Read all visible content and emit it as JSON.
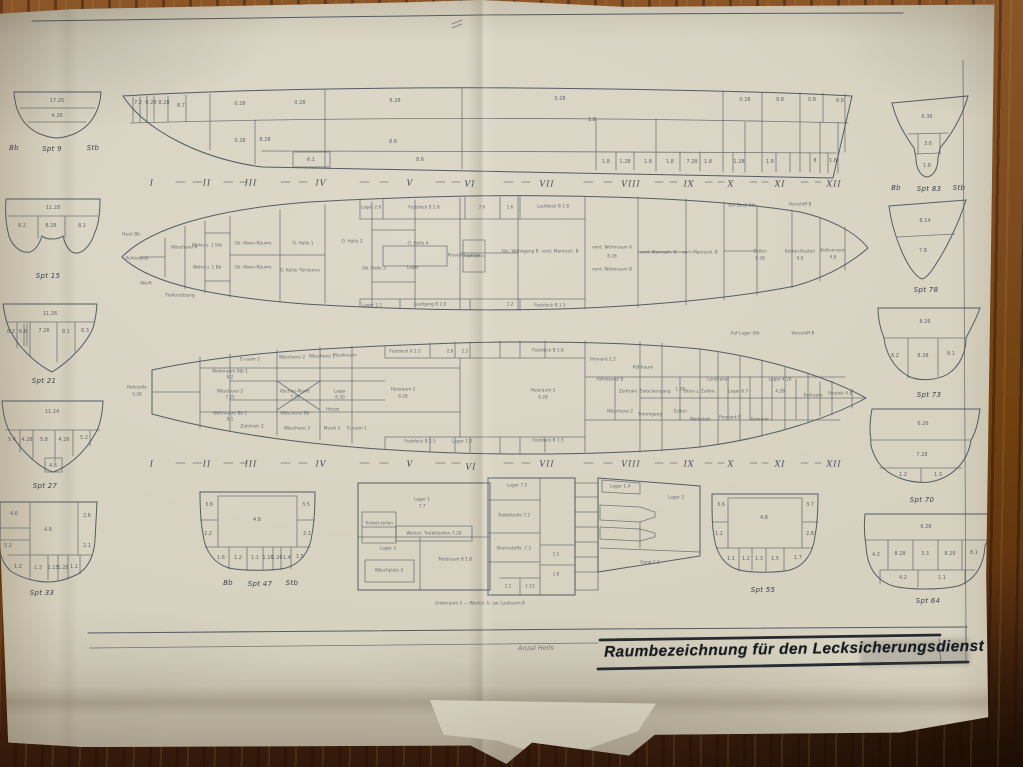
{
  "colors": {
    "paper": "#d7d1bf",
    "ink": "#46535f",
    "wood": "#7c4a1e",
    "title_ink": "#151a21"
  },
  "title_block": {
    "title": "Raumbezeichnung für den Lecksicherungsdienst",
    "annotation": "Anzal Heils"
  },
  "labels": [
    {
      "group": "frame-numerals-top",
      "cls": "rom",
      "items": [
        [
          152,
          183,
          "I"
        ],
        [
          207,
          183,
          "II"
        ],
        [
          251,
          183,
          "III"
        ],
        [
          321,
          183,
          "IV"
        ],
        [
          410,
          183,
          "V"
        ],
        [
          470,
          184,
          "VI"
        ],
        [
          547,
          184,
          "VII"
        ],
        [
          631,
          184,
          "VIII"
        ],
        [
          689,
          184,
          "IX"
        ],
        [
          731,
          184,
          "X"
        ],
        [
          780,
          184,
          "XI"
        ],
        [
          834,
          184,
          "XII"
        ]
      ]
    },
    {
      "group": "frame-numerals-bottom",
      "cls": "rom",
      "items": [
        [
          152,
          464,
          "I"
        ],
        [
          207,
          464,
          "II"
        ],
        [
          251,
          464,
          "III"
        ],
        [
          321,
          464,
          "IV"
        ],
        [
          410,
          464,
          "V"
        ],
        [
          471,
          467,
          "VI"
        ],
        [
          547,
          464,
          "VII"
        ],
        [
          631,
          464,
          "VIII"
        ],
        [
          689,
          464,
          "IX"
        ],
        [
          731,
          464,
          "X"
        ],
        [
          780,
          464,
          "XI"
        ],
        [
          834,
          464,
          "XII"
        ]
      ]
    },
    {
      "group": "section-titles",
      "cls": "spt",
      "items": [
        [
          14,
          148,
          "Bb",
          "section-label-bb-aft"
        ],
        [
          52,
          149,
          "Spt 9",
          "section-label-spt-9"
        ],
        [
          93,
          148,
          "Stb",
          "section-label-stb-aft"
        ],
        [
          48,
          276,
          "Spt 15",
          "section-label-spt-15"
        ],
        [
          44,
          381,
          "Spt 21",
          "section-label-spt-21"
        ],
        [
          45,
          486,
          "Spt 27",
          "section-label-spt-27"
        ],
        [
          42,
          593,
          "Spt 33",
          "section-label-spt-33"
        ],
        [
          896,
          188,
          "Bb",
          "section-label-bb-fwd"
        ],
        [
          929,
          189,
          "Spt 83",
          "section-label-spt-83"
        ],
        [
          959,
          188,
          "Stb",
          "section-label-stb-fwd"
        ],
        [
          926,
          290,
          "Spt 78",
          "section-label-spt-78"
        ],
        [
          929,
          395,
          "Spt 73",
          "section-label-spt-73"
        ],
        [
          922,
          500,
          "Spt 70",
          "section-label-spt-70"
        ],
        [
          928,
          601,
          "Spt 64",
          "section-label-spt-64"
        ],
        [
          228,
          583,
          "Bb",
          "section-label-bb-mid"
        ],
        [
          260,
          584,
          "Spt 47",
          "section-label-spt-47"
        ],
        [
          292,
          583,
          "Stb",
          "section-label-stb-mid"
        ],
        [
          763,
          590,
          "Spt 55",
          "section-label-spt-55"
        ]
      ]
    },
    {
      "group": "section-cells",
      "cls": "num",
      "items": [
        [
          57,
          101,
          "17.25"
        ],
        [
          57,
          116,
          "4.26"
        ],
        [
          53,
          208,
          "11.28"
        ],
        [
          22,
          226,
          "8.2"
        ],
        [
          51,
          226,
          "8.28"
        ],
        [
          82,
          226,
          "8.1"
        ],
        [
          50,
          314,
          "11.26"
        ],
        [
          11,
          332,
          "8.2"
        ],
        [
          23,
          332,
          "6.6"
        ],
        [
          44,
          331,
          "7.26"
        ],
        [
          66,
          332,
          "8.1"
        ],
        [
          85,
          331,
          "8.3"
        ],
        [
          52,
          412,
          "11.24"
        ],
        [
          12,
          440,
          "5.4"
        ],
        [
          27,
          440,
          "4.28"
        ],
        [
          44,
          440,
          "5.8"
        ],
        [
          64,
          440,
          "4.26"
        ],
        [
          84,
          438,
          "5.2"
        ],
        [
          53,
          466,
          "4.6"
        ],
        [
          14,
          514,
          "4.6"
        ],
        [
          48,
          530,
          "4.8"
        ],
        [
          87,
          516,
          "2.6"
        ],
        [
          8,
          546,
          "5.2"
        ],
        [
          87,
          546,
          "2.1"
        ],
        [
          18,
          567,
          "1.2"
        ],
        [
          38,
          568,
          "1.3"
        ],
        [
          53,
          568,
          "1.15"
        ],
        [
          63,
          568,
          "1.28"
        ],
        [
          74,
          567,
          "1.1"
        ],
        [
          927,
          117,
          "6.36"
        ],
        [
          928,
          144,
          "3.6"
        ],
        [
          927,
          166,
          "1.8"
        ],
        [
          925,
          221,
          "8.14"
        ],
        [
          923,
          251,
          "7.8"
        ],
        [
          925,
          322,
          "8.26"
        ],
        [
          895,
          356,
          "8.2"
        ],
        [
          923,
          356,
          "8.28"
        ],
        [
          951,
          354,
          "8.1"
        ],
        [
          923,
          424,
          "6.26"
        ],
        [
          922,
          455,
          "7.28"
        ],
        [
          903,
          475,
          "1.2"
        ],
        [
          938,
          475,
          "1.3"
        ],
        [
          926,
          527,
          "6.28"
        ],
        [
          876,
          555,
          "4.2"
        ],
        [
          900,
          554,
          "8.28"
        ],
        [
          925,
          554,
          "3.3"
        ],
        [
          950,
          554,
          "8.26"
        ],
        [
          974,
          553,
          "8.1"
        ],
        [
          903,
          578,
          "4.2"
        ],
        [
          942,
          578,
          "1.1"
        ],
        [
          209,
          505,
          "3.6"
        ],
        [
          257,
          520,
          "4.8"
        ],
        [
          306,
          505,
          "3.5"
        ],
        [
          208,
          534,
          "2.2"
        ],
        [
          307,
          534,
          "2.1"
        ],
        [
          221,
          558,
          "1.6"
        ],
        [
          238,
          558,
          "1.2"
        ],
        [
          255,
          558,
          "1.1"
        ],
        [
          268,
          558,
          "1.16"
        ],
        [
          277,
          558,
          "1.26"
        ],
        [
          287,
          558,
          "1.4"
        ],
        [
          300,
          557,
          "1.5"
        ],
        [
          721,
          505,
          "3.6"
        ],
        [
          764,
          518,
          "4.8"
        ],
        [
          810,
          505,
          "3.7"
        ],
        [
          719,
          534,
          "1.2"
        ],
        [
          810,
          534,
          "2.8"
        ],
        [
          731,
          559,
          "1.1"
        ],
        [
          746,
          559,
          "1.2"
        ],
        [
          759,
          559,
          "1.3"
        ],
        [
          775,
          559,
          "1.5"
        ],
        [
          798,
          558,
          "1.7"
        ]
      ]
    },
    {
      "group": "profile-cells",
      "cls": "num",
      "items": [
        [
          138,
          103,
          "7.2"
        ],
        [
          151,
          103,
          "0.28"
        ],
        [
          164,
          103,
          "8.28"
        ],
        [
          181,
          106,
          "8.7"
        ],
        [
          240,
          104,
          "0.28"
        ],
        [
          300,
          103,
          "0.28"
        ],
        [
          395,
          101,
          "8.28"
        ],
        [
          560,
          99,
          "0.28"
        ],
        [
          592,
          120,
          "1.8"
        ],
        [
          745,
          100,
          "0.28"
        ],
        [
          780,
          100,
          "9.8"
        ],
        [
          812,
          100,
          "0.8"
        ],
        [
          840,
          101,
          "8.8"
        ],
        [
          265,
          140,
          "8.28"
        ],
        [
          393,
          142,
          "8.8"
        ],
        [
          240,
          141,
          "0.28"
        ],
        [
          311,
          160,
          "6.1"
        ],
        [
          420,
          160,
          "8.6"
        ],
        [
          606,
          162,
          "1.8"
        ],
        [
          625,
          162,
          "1.28"
        ],
        [
          648,
          162,
          "1.8"
        ],
        [
          670,
          162,
          "1.8"
        ],
        [
          692,
          162,
          "7.28"
        ],
        [
          708,
          162,
          "1.8"
        ],
        [
          739,
          162,
          "1.28"
        ],
        [
          770,
          162,
          "1.8"
        ],
        [
          815,
          161,
          "8"
        ],
        [
          833,
          161,
          "1.8"
        ]
      ]
    },
    {
      "group": "upper-deck-rooms",
      "cls": "mic",
      "items": [
        [
          131,
          235,
          "Heck Bb"
        ],
        [
          137,
          259,
          "Achterpiek"
        ],
        [
          146,
          284,
          "Werft"
        ],
        [
          180,
          296,
          "Tiefersetzung"
        ],
        [
          184,
          248,
          "Wäscherei 4"
        ],
        [
          207,
          246,
          "Wohn u. 1 Stb"
        ],
        [
          207,
          268,
          "Wohn u. 1 Bb"
        ],
        [
          253,
          244,
          "Ob. Mann-Räume"
        ],
        [
          253,
          268,
          "Ob. Mann-Räume"
        ],
        [
          303,
          244,
          "O. Halle 1"
        ],
        [
          352,
          242,
          "O. Halle 2"
        ],
        [
          300,
          271,
          "O. Keller Türräume"
        ],
        [
          374,
          269,
          "Ob. Halle 3"
        ],
        [
          418,
          244,
          "O. Halle 4"
        ],
        [
          413,
          268,
          "Lager"
        ],
        [
          464,
          256,
          "Proviant-gänge"
        ],
        [
          520,
          252,
          "Hin. Wohngang B"
        ],
        [
          560,
          252,
          "vord. Mannsch. B"
        ],
        [
          612,
          248,
          "vord. Wohnraum A"
        ],
        [
          612,
          257,
          "8.28"
        ],
        [
          612,
          270,
          "vord. Wohnraum B"
        ],
        [
          658,
          253,
          "vord. Mannsch. B"
        ],
        [
          700,
          253,
          "vorn Mannsch. B"
        ],
        [
          760,
          252,
          "Zellen"
        ],
        [
          760,
          259,
          "6.28"
        ],
        [
          800,
          252,
          "Ketten-Kasten"
        ],
        [
          800,
          259,
          "6.8"
        ],
        [
          833,
          251,
          "Kettenraum"
        ],
        [
          833,
          258,
          "4.8"
        ],
        [
          371,
          208,
          "Lager 2.6"
        ],
        [
          424,
          208,
          "Festdeck B 2.6"
        ],
        [
          482,
          208,
          "7.6"
        ],
        [
          510,
          208,
          "1.6"
        ],
        [
          553,
          207,
          "Laufdeck B 1.8"
        ],
        [
          372,
          306,
          "Lager 2.1"
        ],
        [
          430,
          305,
          "Laufgang B 2.8"
        ],
        [
          510,
          305,
          "1.2"
        ],
        [
          550,
          306,
          "Festdeck B 1.5"
        ],
        [
          742,
          206,
          "Auf Deck Stb"
        ],
        [
          800,
          205,
          "Vorschiff B"
        ]
      ]
    },
    {
      "group": "lower-deck-rooms",
      "cls": "mic",
      "items": [
        [
          137,
          388,
          "Rohrzelle"
        ],
        [
          137,
          395,
          "5.28"
        ],
        [
          230,
          372,
          "Wohnraum Stb 1"
        ],
        [
          230,
          378,
          "9.2"
        ],
        [
          250,
          360,
          "E-raum 2"
        ],
        [
          292,
          358,
          "Wäscherei 2"
        ],
        [
          322,
          357,
          "Wäscherei 1"
        ],
        [
          345,
          356,
          "Musikraum"
        ],
        [
          230,
          392,
          "Wäscherei 2"
        ],
        [
          230,
          398,
          "7.25"
        ],
        [
          295,
          392,
          "Küchen-Markt"
        ],
        [
          295,
          398,
          "7.28"
        ],
        [
          340,
          392,
          "Lager"
        ],
        [
          340,
          398,
          "6.30"
        ],
        [
          230,
          414,
          "Wohnraum Bb 1"
        ],
        [
          230,
          420,
          "9.1"
        ],
        [
          295,
          414,
          "Wäscherei Bb"
        ],
        [
          333,
          410,
          "Heizer"
        ],
        [
          252,
          427,
          "Zahlmstr 2"
        ],
        [
          297,
          429,
          "Wäscherei 3"
        ],
        [
          332,
          429,
          "Musik 2"
        ],
        [
          357,
          429,
          "E-raum 1"
        ],
        [
          403,
          390,
          "Heizraum 2"
        ],
        [
          403,
          397,
          "6.28"
        ],
        [
          543,
          391,
          "Heizraum 1"
        ],
        [
          543,
          398,
          "6.28"
        ],
        [
          405,
          352,
          "Festdeck A 2.2"
        ],
        [
          450,
          352,
          "2.8"
        ],
        [
          465,
          352,
          "2.2"
        ],
        [
          548,
          351,
          "Festdeck B 1.8"
        ],
        [
          420,
          442,
          "Festdeck B 2.5"
        ],
        [
          462,
          442,
          "Lager 1.0"
        ],
        [
          548,
          441,
          "Festdeck B 1.5"
        ],
        [
          603,
          360,
          "Proviant 2.2"
        ],
        [
          643,
          368,
          "Kühlraum"
        ],
        [
          610,
          380,
          "Hilfskessel B"
        ],
        [
          628,
          392,
          "Zentrale"
        ],
        [
          655,
          392,
          "Zwischengang"
        ],
        [
          680,
          390,
          "1.28"
        ],
        [
          700,
          392,
          "Büro u. Zahlm."
        ],
        [
          718,
          380,
          "Lenzkanal"
        ],
        [
          738,
          392,
          "Lager 6.7"
        ],
        [
          780,
          380,
          "Lager 4.28"
        ],
        [
          780,
          392,
          "4.28"
        ],
        [
          813,
          396,
          "Seilraum"
        ],
        [
          840,
          394,
          "Vorpiek 4.8"
        ],
        [
          620,
          412,
          "Wäscherei 2"
        ],
        [
          650,
          415,
          "Trimmgang"
        ],
        [
          680,
          412,
          "Zellen"
        ],
        [
          700,
          420,
          "Werkstatt"
        ],
        [
          730,
          418,
          "Proviant B"
        ],
        [
          760,
          420,
          "Kammer"
        ],
        [
          745,
          334,
          "Auf Lager Stb"
        ],
        [
          803,
          334,
          "Vorschiff B"
        ]
      ]
    },
    {
      "group": "detail-plan-rooms",
      "cls": "mic",
      "items": [
        [
          422,
          500,
          "Lager 1"
        ],
        [
          422,
          507,
          "7.7"
        ],
        [
          379,
          524,
          "Treiböl-zellen"
        ],
        [
          434,
          534,
          "Werkst. Treibölzellen 7.28"
        ],
        [
          388,
          549,
          "Lager 3"
        ],
        [
          389,
          571,
          "Wäschplatz 2"
        ],
        [
          455,
          560,
          "Treibraum B 1.8"
        ],
        [
          517,
          486,
          "Lager 7.5"
        ],
        [
          514,
          516,
          "Treibölzelle 7.2"
        ],
        [
          514,
          549,
          "Brennstoffz. 7.3"
        ],
        [
          556,
          555,
          "1.5"
        ],
        [
          556,
          575,
          "1.8"
        ],
        [
          508,
          587,
          "1.1"
        ],
        [
          530,
          587,
          "1.15"
        ],
        [
          620,
          487,
          "Lager 1.4"
        ],
        [
          676,
          498,
          "Lager 2"
        ],
        [
          650,
          563,
          "Gang 1.1"
        ],
        [
          480,
          604,
          "Unterraum 2 — Werkst. b. zw. Lastraum B"
        ]
      ]
    }
  ]
}
